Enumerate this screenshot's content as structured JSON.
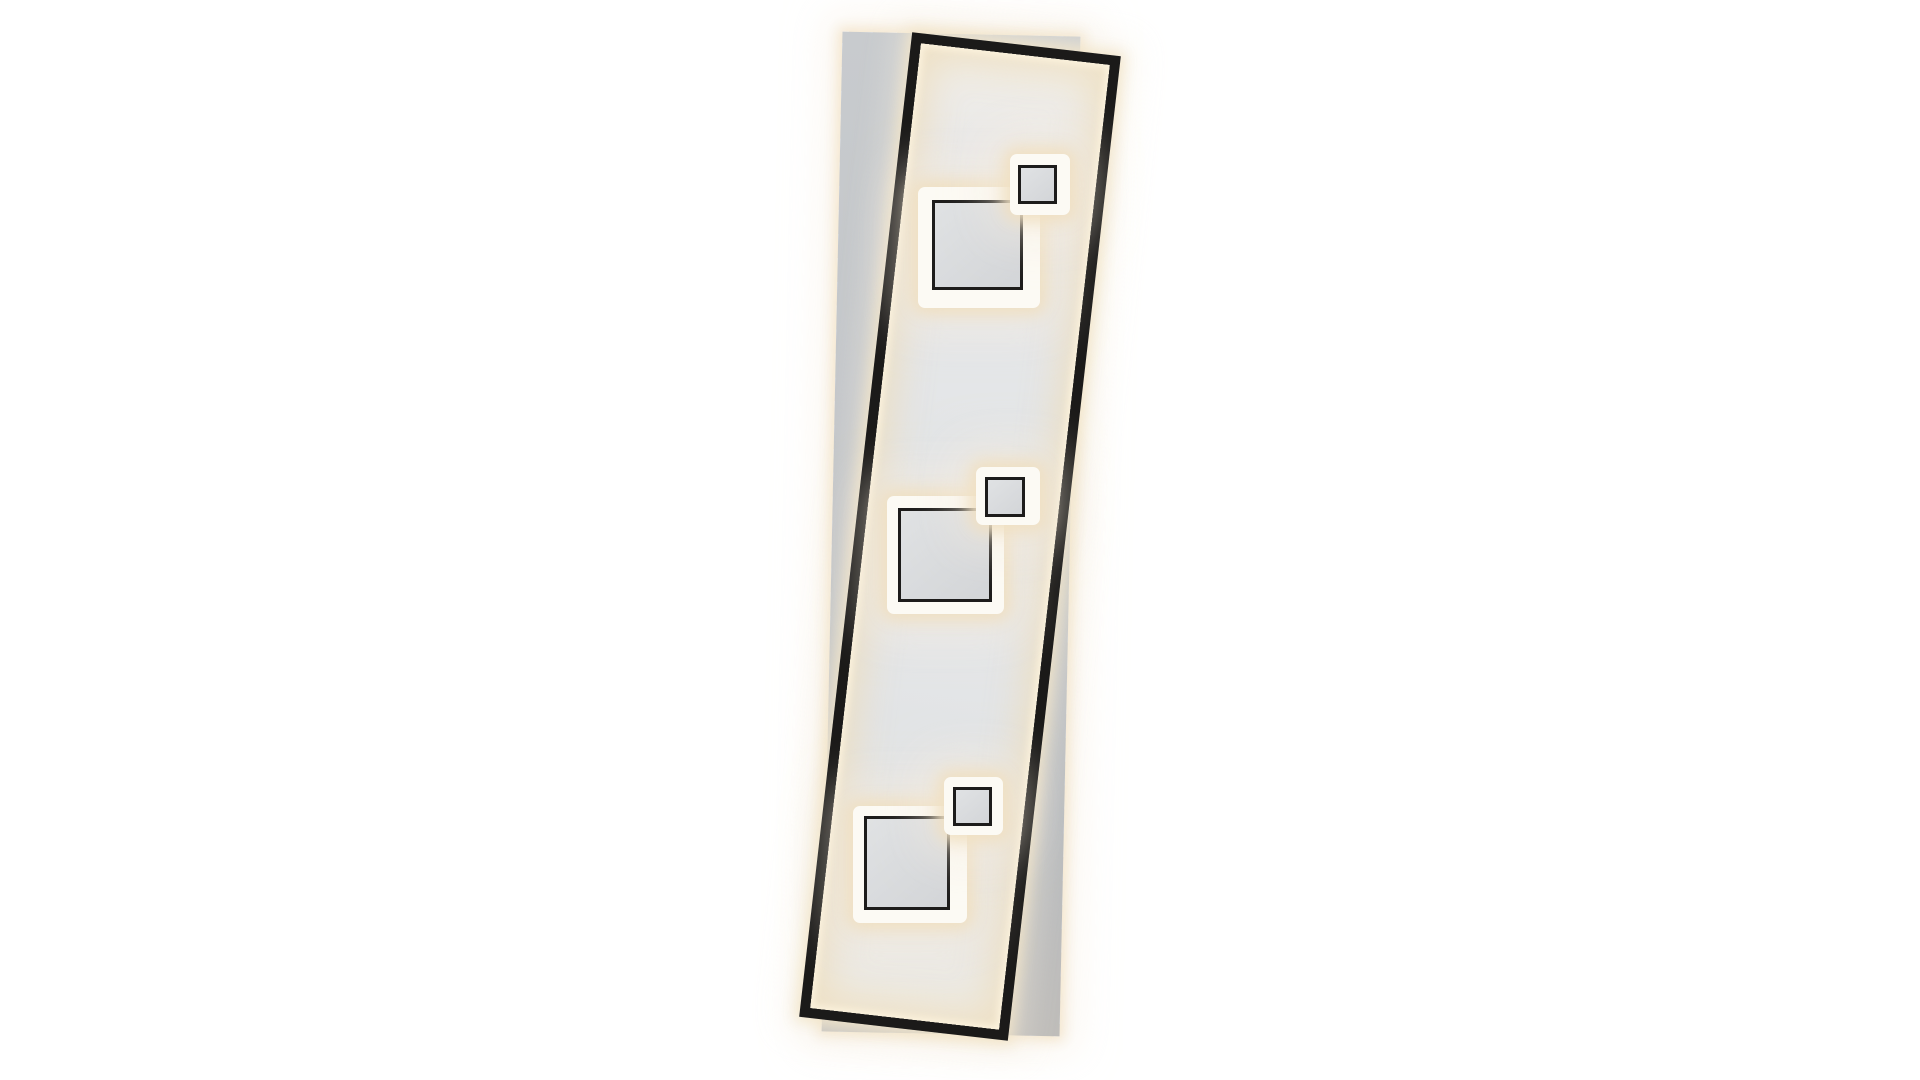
{
  "image": {
    "type": "product-photo",
    "subject": "rectangular LED panel ceiling lamp, black tilted frame over grey back panel, three backlit square modules",
    "background": "plain white",
    "module_count": 3
  },
  "colors": {
    "background": "#ffffff",
    "backplate-top": "#c8cbce",
    "backplate-bottom": "#b7babe",
    "frame-black": "#1b1a19",
    "outline-black": "#1d1c1b",
    "panel-base": "#e6e7e9",
    "glow-bright": "#fdf4df",
    "glow-warm": "#efdfc2",
    "plate-white": "#fcfaf4",
    "square-fill-light": "#e0e2e4",
    "square-fill": "#d3d5d8"
  },
  "lamp": {
    "back_panel": {
      "x": 832,
      "y": 34,
      "w": 238,
      "h": 1000,
      "rotation_deg": 1.2
    },
    "front_frame": {
      "x": 855,
      "y": 41,
      "w": 210,
      "h": 991,
      "rotation_deg": 6.55,
      "border_px": 10
    },
    "motifs": [
      {
        "name": "top",
        "big_plate": {
          "x": 918,
          "y": 187,
          "w": 122,
          "h": 121
        },
        "big_square": {
          "x": 932,
          "y": 200,
          "w": 91,
          "h": 90
        },
        "small_plate": {
          "x": 1010,
          "y": 154,
          "w": 60,
          "h": 61
        },
        "small_square": {
          "x": 1018,
          "y": 165,
          "w": 39,
          "h": 39
        }
      },
      {
        "name": "middle",
        "big_plate": {
          "x": 887,
          "y": 496,
          "w": 117,
          "h": 118
        },
        "big_square": {
          "x": 898,
          "y": 508,
          "w": 94,
          "h": 94
        },
        "small_plate": {
          "x": 976,
          "y": 467,
          "w": 64,
          "h": 58
        },
        "small_square": {
          "x": 985,
          "y": 477,
          "w": 40,
          "h": 40
        }
      },
      {
        "name": "bottom",
        "big_plate": {
          "x": 853,
          "y": 806,
          "w": 114,
          "h": 117
        },
        "big_square": {
          "x": 864,
          "y": 816,
          "w": 86,
          "h": 94
        },
        "small_plate": {
          "x": 944,
          "y": 777,
          "w": 59,
          "h": 58
        },
        "small_square": {
          "x": 953,
          "y": 787,
          "w": 39,
          "h": 39
        }
      }
    ]
  }
}
